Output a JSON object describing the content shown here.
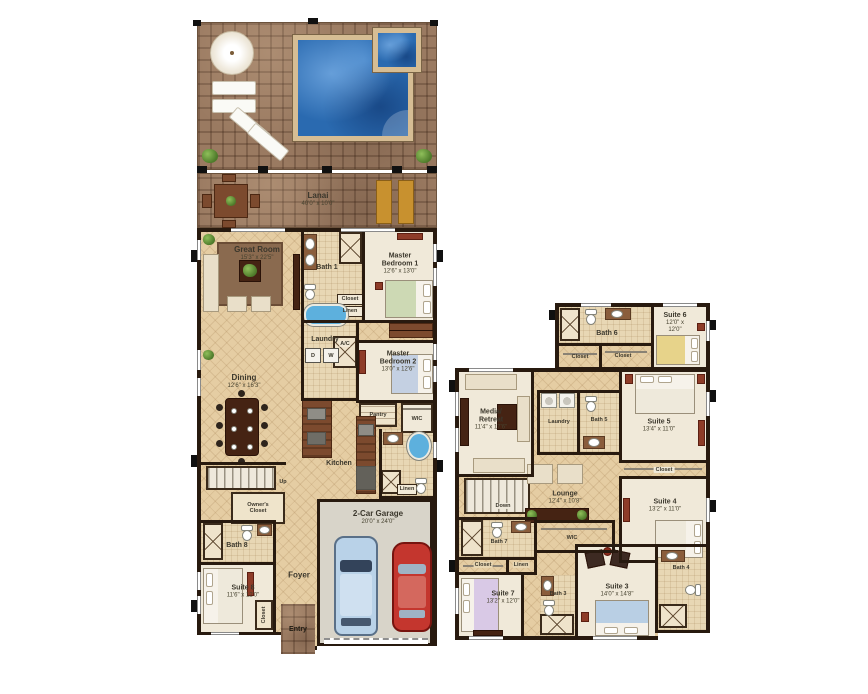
{
  "f1": {
    "lanai": {
      "name": "Lanai",
      "dims": "40'0\" x 10'0\""
    },
    "great_room": {
      "name": "Great Room",
      "dims": "15'3\" x 22'5\""
    },
    "bath1": {
      "name": "Bath 1"
    },
    "master_bedroom_1": {
      "name": "Master Bedroom 1",
      "dims": "12'6\" x 13'0\""
    },
    "closet1": {
      "name": "Closet"
    },
    "linen1": {
      "name": "Linen"
    },
    "laundry": {
      "name": "Laundry"
    },
    "dryer": "D",
    "washer": "W",
    "ac": {
      "name": "A/C"
    },
    "master_bedroom_2": {
      "name": "Master Bedroom 2",
      "dims": "13'0\" x 12'6\""
    },
    "dining": {
      "name": "Dining",
      "dims": "12'6\" x 16'3\""
    },
    "kitchen": {
      "name": "Kitchen"
    },
    "pantry": {
      "name": "Pantry"
    },
    "wic": {
      "name": "WIC"
    },
    "linen2": {
      "name": "Linen"
    },
    "up": {
      "name": "Up"
    },
    "owners_closet": {
      "name": "Owner's Closet"
    },
    "bath8": {
      "name": "Bath 8"
    },
    "suite8": {
      "name": "Suite 8",
      "dims": "11'6\" x 12'0\""
    },
    "closet2": {
      "name": "Closet"
    },
    "foyer": {
      "name": "Foyer"
    },
    "entry": {
      "name": "Entry"
    },
    "garage": {
      "name": "2-Car Garage",
      "dims": "20'0\" x 24'0\""
    }
  },
  "f2": {
    "bath6": {
      "name": "Bath 6"
    },
    "closet_a": {
      "name": "Closet"
    },
    "closet_b": {
      "name": "Closet"
    },
    "suite6": {
      "name": "Suite 6",
      "dims": "12'0\" x 12'0\""
    },
    "media": {
      "line1": "Media/",
      "line2": "Retreat",
      "dims": "11'4\" x 17'6\""
    },
    "laundry": {
      "name": "Laundry"
    },
    "bath5": {
      "name": "Bath 5"
    },
    "suite5": {
      "name": "Suite 5",
      "dims": "13'4\" x 11'0\""
    },
    "closet_c": {
      "name": "Closet"
    },
    "suite4": {
      "name": "Suite 4",
      "dims": "13'2\" x 11'0\""
    },
    "lounge": {
      "name": "Lounge",
      "dims": "12'4\" x 10'8\""
    },
    "down": {
      "name": "Down"
    },
    "bath7": {
      "name": "Bath 7"
    },
    "closet_d": {
      "name": "Closet"
    },
    "linen": {
      "name": "Linen"
    },
    "wic": {
      "name": "WIC"
    },
    "suite7": {
      "name": "Suite 7",
      "dims": "13'2\" x 12'0\""
    },
    "bath3": {
      "name": "Bath 3"
    },
    "suite3": {
      "name": "Suite 3",
      "dims": "14'0\" x 14'8\""
    },
    "bath4": {
      "name": "Bath 4"
    }
  },
  "colors": {
    "wall": "#281a0f",
    "water": "#2a6ab0",
    "brick": "#9a7a61",
    "tile": "#e5cda3",
    "carpet": "#f0e9d9",
    "garage_floor": "#d8d4c9"
  }
}
